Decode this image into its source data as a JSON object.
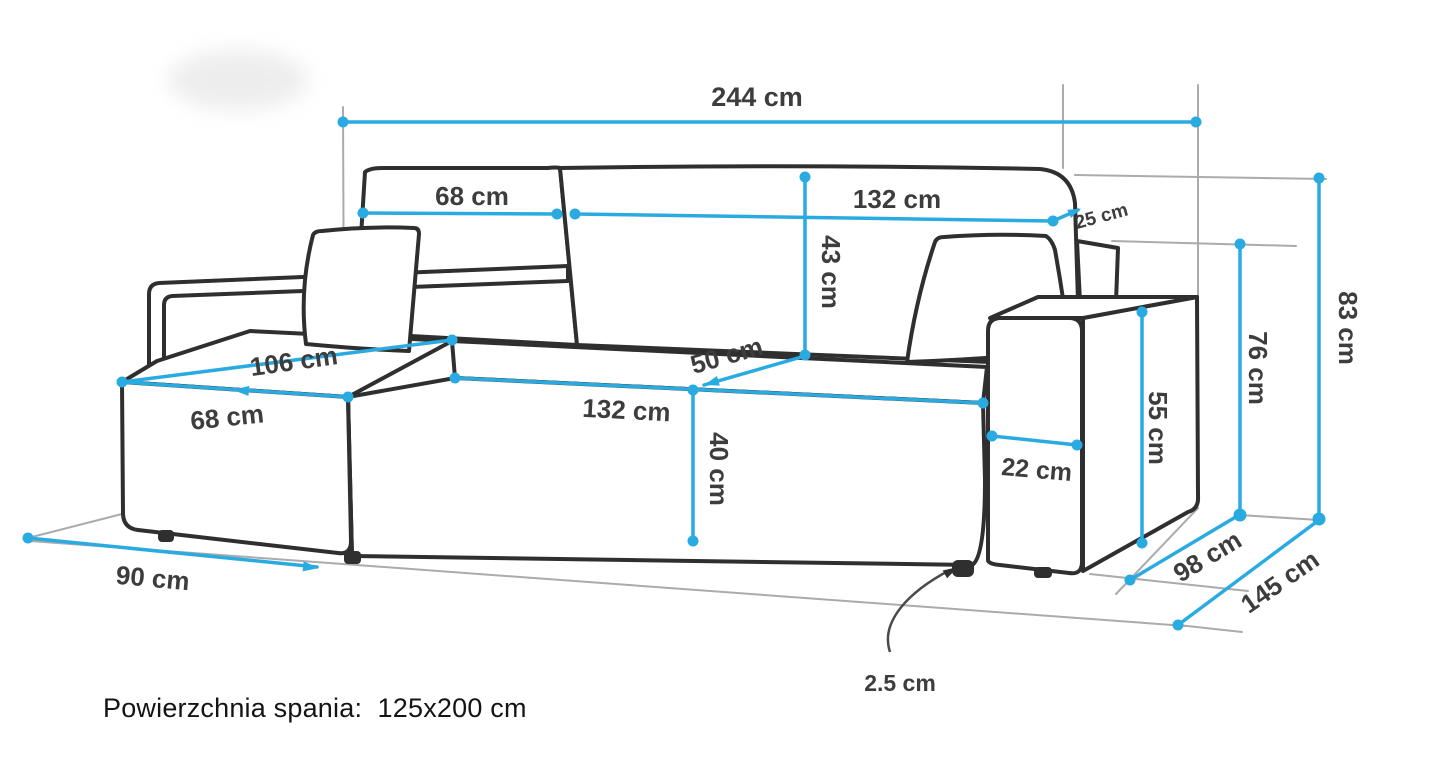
{
  "figure": {
    "kind": "corner-sofa dimension diagram",
    "colors": {
      "dimension_line": "#29abe2",
      "sofa_outline": "#2f2f2f",
      "guide_line": "#ababab",
      "label_text": "#3d3d3d"
    }
  },
  "dimensions": {
    "total_width": {
      "label": "244 cm"
    },
    "backrest_left": {
      "label": "68 cm"
    },
    "backrest_right": {
      "label": "132 cm"
    },
    "backrest_depth": {
      "label": "25 cm"
    },
    "backrest_height": {
      "label": "43 cm"
    },
    "seat_depth": {
      "label": "50 cm"
    },
    "chaise_length": {
      "label": "106 cm"
    },
    "chaise_width": {
      "label": "68 cm"
    },
    "seat_width": {
      "label": "132 cm"
    },
    "seat_height": {
      "label": "40 cm"
    },
    "armrest_width": {
      "label": "22 cm"
    },
    "armrest_height": {
      "label": "55 cm"
    },
    "back_height": {
      "label": "76 cm"
    },
    "total_height": {
      "label": "83 cm"
    },
    "chaise_side_depth": {
      "label": "90 cm"
    },
    "body_depth": {
      "label": "98 cm"
    },
    "total_depth": {
      "label": "145 cm"
    },
    "leg_height": {
      "label": "2.5 cm"
    }
  },
  "footer": {
    "sleeping_area": "Powierzchnia spania:  125x200 cm"
  }
}
